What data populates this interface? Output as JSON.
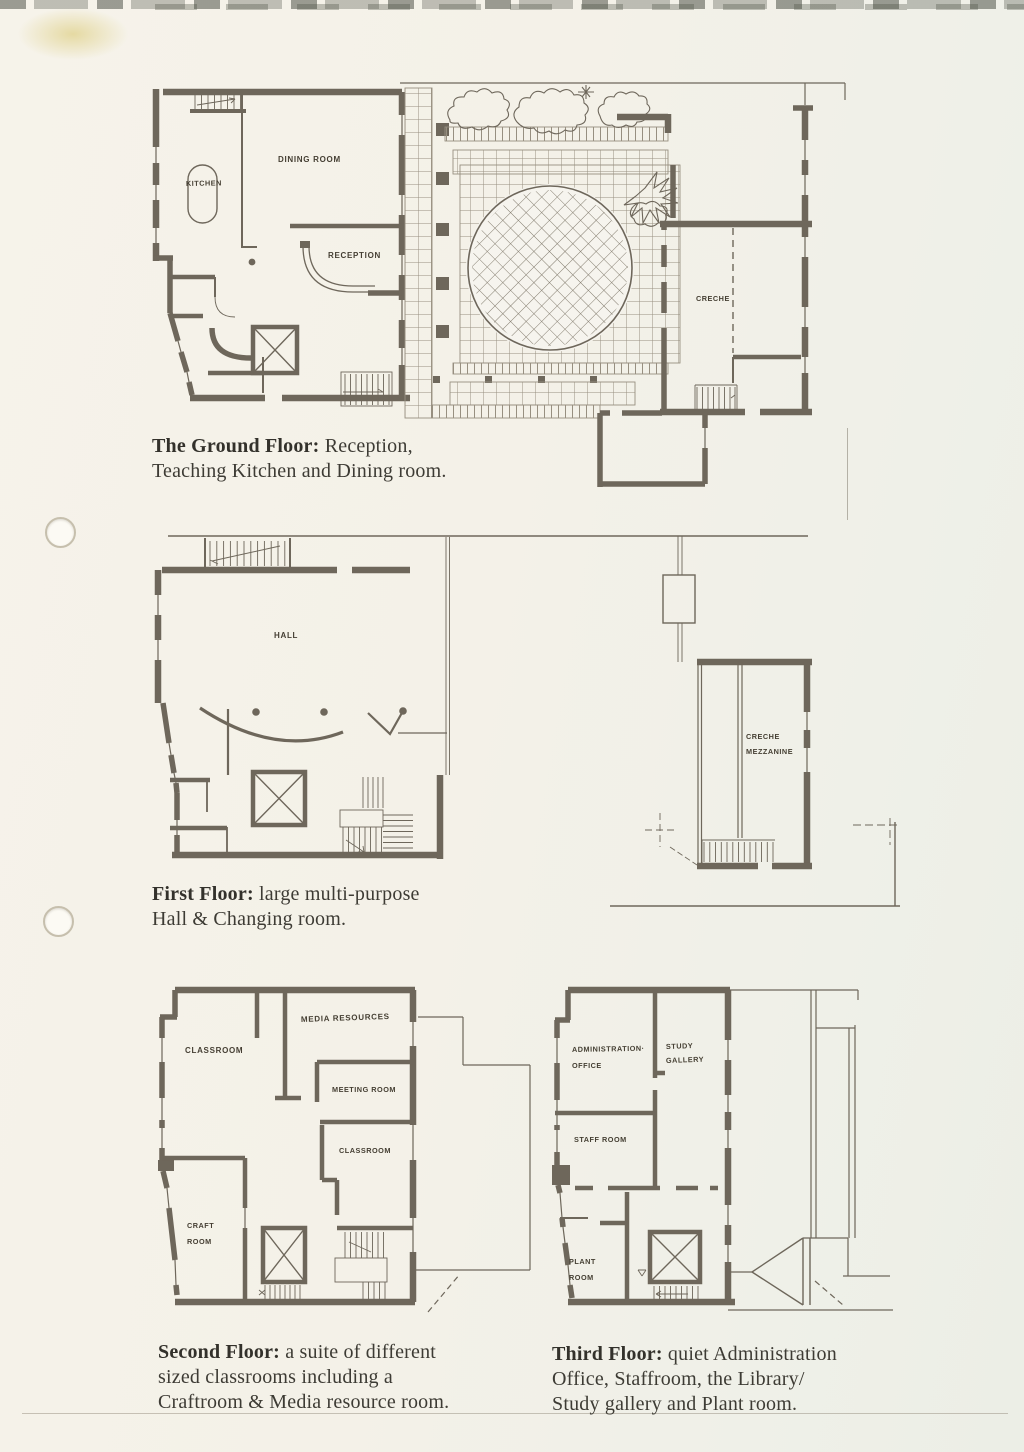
{
  "document": {
    "colors": {
      "paper": "#f4f1e8",
      "ink": "#6e675b",
      "caption_text": "#3d3b34"
    },
    "captions": [
      {
        "lead": "The Ground Floor:",
        "line1_rest": " Reception,",
        "line2": "Teaching Kitchen and Dining room.",
        "line3": ""
      },
      {
        "lead": "First Floor:",
        "line1_rest": " large multi-purpose",
        "line2": "Hall & Changing room.",
        "line3": ""
      },
      {
        "lead": "Second Floor:",
        "line1_rest": " a suite of different",
        "line2": "sized classrooms including a",
        "line3": "Craftroom & Media resource room."
      },
      {
        "lead": "Third Floor:",
        "line1_rest": " quiet Administration",
        "line2": "Office, Staffroom, the Library/",
        "line3": "Study gallery and Plant room."
      }
    ],
    "plans": {
      "ground_floor": {
        "labels": {
          "kitchen": "KITCHEN",
          "dining_room": "DINING ROOM",
          "reception": "RECEPTION",
          "creche": "CRECHE"
        }
      },
      "first_floor": {
        "labels": {
          "hall": "HALL",
          "creche_mezzanine_line1": "CRECHE",
          "creche_mezzanine_line2": "MEZZANINE"
        }
      },
      "second_floor": {
        "labels": {
          "classroom_upper": "CLASSROOM",
          "media_resources": "MEDIA RESOURCES",
          "meeting_room": "MEETING ROOM",
          "classroom_lower": "CLASSROOM",
          "craft_room_line1": "CRAFT",
          "craft_room_line2": "ROOM"
        }
      },
      "third_floor": {
        "labels": {
          "administration_office_line1": "ADMINISTRATION·",
          "administration_office_line2": "OFFICE",
          "study_gallery_line1": "STUDY",
          "study_gallery_line2": "GALLERY",
          "staff_room": "STAFF ROOM",
          "plant_room_line1": "PLANT",
          "plant_room_line2": "ROOM"
        }
      }
    }
  }
}
